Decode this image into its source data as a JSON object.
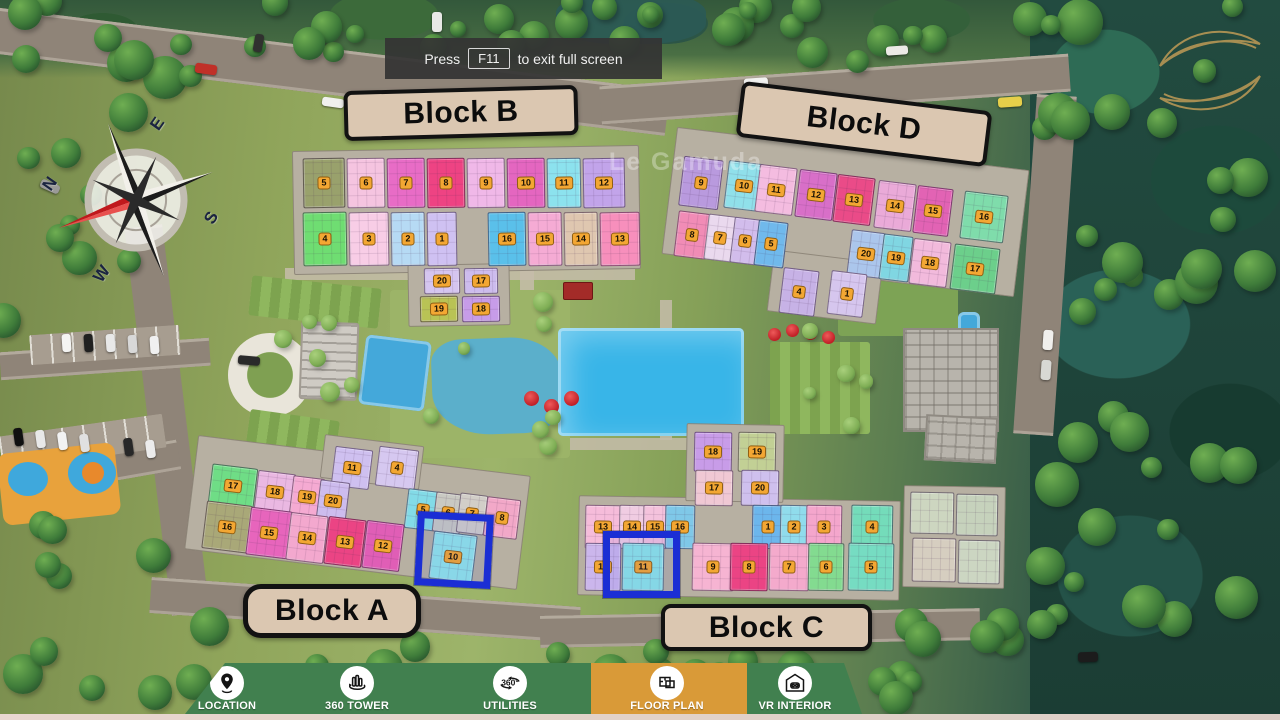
{
  "toast": {
    "prefix": "Press",
    "key": "F11",
    "suffix": "to exit full screen"
  },
  "watermark": "Le Gamuda",
  "compass": {
    "n": "N",
    "e": "E",
    "s": "S",
    "w": "W"
  },
  "block_labels": [
    {
      "text": "Block B"
    },
    {
      "text": "Block D"
    },
    {
      "text": "Block A"
    },
    {
      "text": "Block C"
    }
  ],
  "highlighted_units": [
    {
      "block": "Block A",
      "unit": "10"
    },
    {
      "block": "Block C",
      "unit": "11"
    }
  ],
  "nav": {
    "background": "#41804f",
    "active_background": "#d99a38",
    "items": [
      {
        "label": "LOCATION",
        "icon": "location-pin-icon",
        "active": false
      },
      {
        "label": "360 TOWER",
        "icon": "tower-360-icon",
        "active": false
      },
      {
        "label": "UTILITIES",
        "icon": "utilities-360-icon",
        "active": false
      },
      {
        "label": "FLOOR PLAN",
        "icon": "floor-plan-icon",
        "active": true
      },
      {
        "label": "VR INTERIOR",
        "icon": "vr-interior-icon",
        "active": false
      }
    ]
  },
  "map": {
    "highlights": [
      {
        "x": 416,
        "y": 513,
        "w": 76,
        "h": 74,
        "rot": 3
      },
      {
        "x": 603,
        "y": 531,
        "w": 77,
        "h": 67,
        "rot": 0
      }
    ],
    "blocks": [
      {
        "name": "Block B",
        "rot": -1,
        "slabs": [
          {
            "x": 293,
            "y": 148,
            "w": 347,
            "h": 124
          },
          {
            "x": 408,
            "y": 264,
            "w": 102,
            "h": 62
          }
        ],
        "units": [
          {
            "n": "5",
            "x": 303,
            "y": 158,
            "w": 42,
            "h": 50,
            "c": "#99a16c"
          },
          {
            "n": "6",
            "x": 347,
            "y": 158,
            "w": 38,
            "h": 50,
            "c": "#f5c4e0"
          },
          {
            "n": "7",
            "x": 387,
            "y": 158,
            "w": 38,
            "h": 50,
            "c": "#e86cc6"
          },
          {
            "n": "8",
            "x": 427,
            "y": 158,
            "w": 38,
            "h": 50,
            "c": "#ee4383"
          },
          {
            "n": "9",
            "x": 467,
            "y": 158,
            "w": 38,
            "h": 50,
            "c": "#f0b8e8"
          },
          {
            "n": "10",
            "x": 507,
            "y": 158,
            "w": 38,
            "h": 50,
            "c": "#e466c0"
          },
          {
            "n": "11",
            "x": 547,
            "y": 158,
            "w": 34,
            "h": 50,
            "c": "#8ce2ee"
          },
          {
            "n": "12",
            "x": 583,
            "y": 158,
            "w": 42,
            "h": 50,
            "c": "#c2a4ea"
          },
          {
            "n": "4",
            "x": 303,
            "y": 212,
            "w": 44,
            "h": 54,
            "c": "#6fdd72"
          },
          {
            "n": "3",
            "x": 349,
            "y": 212,
            "w": 40,
            "h": 54,
            "c": "#f8cde6"
          },
          {
            "n": "2",
            "x": 391,
            "y": 212,
            "w": 34,
            "h": 54,
            "c": "#b6daf4"
          },
          {
            "n": "1",
            "x": 427,
            "y": 212,
            "w": 30,
            "h": 54,
            "c": "#cfc1f2"
          },
          {
            "n": "16",
            "x": 488,
            "y": 212,
            "w": 38,
            "h": 54,
            "c": "#5ac0ea"
          },
          {
            "n": "15",
            "x": 528,
            "y": 212,
            "w": 34,
            "h": 54,
            "c": "#f5abd4"
          },
          {
            "n": "14",
            "x": 564,
            "y": 212,
            "w": 34,
            "h": 54,
            "c": "#dfc7b0"
          },
          {
            "n": "13",
            "x": 600,
            "y": 212,
            "w": 40,
            "h": 54,
            "c": "#f78fbc"
          },
          {
            "n": "20",
            "x": 424,
            "y": 268,
            "w": 36,
            "h": 26,
            "c": "#d5c5f0"
          },
          {
            "n": "17",
            "x": 464,
            "y": 268,
            "w": 34,
            "h": 26,
            "c": "#cdbcee"
          },
          {
            "n": "19",
            "x": 420,
            "y": 296,
            "w": 38,
            "h": 26,
            "c": "#b9c355"
          },
          {
            "n": "18",
            "x": 462,
            "y": 296,
            "w": 38,
            "h": 26,
            "c": "#c79ce8"
          }
        ]
      },
      {
        "name": "Block D",
        "rot": 7,
        "slabs": [
          {
            "x": 668,
            "y": 148,
            "w": 355,
            "h": 128
          },
          {
            "x": 770,
            "y": 256,
            "w": 110,
            "h": 62
          }
        ],
        "units": [
          {
            "n": "9",
            "x": 681,
            "y": 158,
            "w": 40,
            "h": 50,
            "c": "#b99ade"
          },
          {
            "n": "10",
            "x": 726,
            "y": 162,
            "w": 36,
            "h": 48,
            "c": "#90e0ea"
          },
          {
            "n": "11",
            "x": 757,
            "y": 166,
            "w": 38,
            "h": 48,
            "c": "#f4bce0"
          },
          {
            "n": "12",
            "x": 797,
            "y": 171,
            "w": 38,
            "h": 48,
            "c": "#d86fc8"
          },
          {
            "n": "13",
            "x": 835,
            "y": 176,
            "w": 38,
            "h": 48,
            "c": "#ea4b88"
          },
          {
            "n": "14",
            "x": 876,
            "y": 182,
            "w": 38,
            "h": 48,
            "c": "#eaaad8"
          },
          {
            "n": "15",
            "x": 915,
            "y": 187,
            "w": 36,
            "h": 48,
            "c": "#e263b4"
          },
          {
            "n": "16",
            "x": 962,
            "y": 193,
            "w": 44,
            "h": 48,
            "c": "#7fdcab"
          },
          {
            "n": "8",
            "x": 676,
            "y": 212,
            "w": 32,
            "h": 46,
            "c": "#f18cb6"
          },
          {
            "n": "7",
            "x": 706,
            "y": 215,
            "w": 28,
            "h": 46,
            "c": "#ead9ee"
          },
          {
            "n": "6",
            "x": 732,
            "y": 218,
            "w": 26,
            "h": 46,
            "c": "#d2bdec"
          },
          {
            "n": "5",
            "x": 756,
            "y": 221,
            "w": 30,
            "h": 46,
            "c": "#70b9ec"
          },
          {
            "n": "20",
            "x": 849,
            "y": 231,
            "w": 34,
            "h": 46,
            "c": "#abc6ec"
          },
          {
            "n": "19",
            "x": 881,
            "y": 235,
            "w": 30,
            "h": 46,
            "c": "#80d6e2"
          },
          {
            "n": "18",
            "x": 911,
            "y": 240,
            "w": 38,
            "h": 46,
            "c": "#f2badc"
          },
          {
            "n": "17",
            "x": 952,
            "y": 246,
            "w": 46,
            "h": 46,
            "c": "#6ccf8b"
          },
          {
            "n": "4",
            "x": 781,
            "y": 269,
            "w": 36,
            "h": 46,
            "c": "#c7b2e6"
          },
          {
            "n": "1",
            "x": 829,
            "y": 272,
            "w": 36,
            "h": 44,
            "c": "#d6c6ee"
          }
        ]
      },
      {
        "name": "Block A",
        "rot": 7,
        "slabs": [
          {
            "x": 190,
            "y": 455,
            "w": 335,
            "h": 115
          },
          {
            "x": 322,
            "y": 440,
            "w": 100,
            "h": 44
          }
        ],
        "units": [
          {
            "n": "11",
            "x": 333,
            "y": 448,
            "w": 38,
            "h": 40,
            "c": "#cfc0f0"
          },
          {
            "n": "4",
            "x": 377,
            "y": 448,
            "w": 40,
            "h": 40,
            "c": "#d6c8f0"
          },
          {
            "n": "17",
            "x": 210,
            "y": 466,
            "w": 46,
            "h": 40,
            "c": "#6fdd86"
          },
          {
            "n": "18",
            "x": 256,
            "y": 472,
            "w": 38,
            "h": 40,
            "c": "#eab8e2"
          },
          {
            "n": "19",
            "x": 291,
            "y": 477,
            "w": 32,
            "h": 40,
            "c": "#f5aad2"
          },
          {
            "n": "20",
            "x": 318,
            "y": 481,
            "w": 30,
            "h": 40,
            "c": "#cdbcee"
          },
          {
            "n": "5",
            "x": 406,
            "y": 490,
            "w": 34,
            "h": 40,
            "c": "#83dbe7"
          },
          {
            "n": "6",
            "x": 434,
            "y": 493,
            "w": 28,
            "h": 40,
            "c": "#c9c9c2"
          },
          {
            "n": "7",
            "x": 458,
            "y": 494,
            "w": 28,
            "h": 40,
            "c": "#d2cec8"
          },
          {
            "n": "8",
            "x": 485,
            "y": 498,
            "w": 34,
            "h": 40,
            "c": "#f2a8c8"
          },
          {
            "n": "16",
            "x": 204,
            "y": 503,
            "w": 46,
            "h": 48,
            "c": "#a9a878"
          },
          {
            "n": "15",
            "x": 248,
            "y": 509,
            "w": 42,
            "h": 48,
            "c": "#e765bc"
          },
          {
            "n": "14",
            "x": 288,
            "y": 514,
            "w": 38,
            "h": 48,
            "c": "#f3a8ce"
          },
          {
            "n": "13",
            "x": 326,
            "y": 518,
            "w": 38,
            "h": 48,
            "c": "#eb4484"
          },
          {
            "n": "12",
            "x": 364,
            "y": 522,
            "w": 38,
            "h": 48,
            "c": "#e05eb6"
          },
          {
            "n": "10",
            "x": 431,
            "y": 533,
            "w": 44,
            "h": 48,
            "c": "#92e4e9"
          }
        ]
      },
      {
        "name": "Block C",
        "rot": 1,
        "slabs": [
          {
            "x": 578,
            "y": 498,
            "w": 322,
            "h": 100
          },
          {
            "x": 686,
            "y": 424,
            "w": 98,
            "h": 78
          },
          {
            "x": 903,
            "y": 486,
            "w": 102,
            "h": 102
          }
        ],
        "units": [
          {
            "n": "18",
            "x": 694,
            "y": 432,
            "w": 38,
            "h": 40,
            "c": "#c89ce8"
          },
          {
            "n": "19",
            "x": 738,
            "y": 432,
            "w": 38,
            "h": 40,
            "c": "#c2d095"
          },
          {
            "n": "17",
            "x": 695,
            "y": 470,
            "w": 38,
            "h": 36,
            "c": "#f0c8d4"
          },
          {
            "n": "20",
            "x": 741,
            "y": 470,
            "w": 38,
            "h": 36,
            "c": "#cfc0ee"
          },
          {
            "n": "13",
            "x": 585,
            "y": 505,
            "w": 36,
            "h": 44,
            "c": "#f6bcda"
          },
          {
            "n": "14",
            "x": 619,
            "y": 505,
            "w": 26,
            "h": 44,
            "c": "#f0cce2"
          },
          {
            "n": "15",
            "x": 643,
            "y": 505,
            "w": 24,
            "h": 44,
            "c": "#f4c2dc"
          },
          {
            "n": "16",
            "x": 665,
            "y": 505,
            "w": 30,
            "h": 44,
            "c": "#7fc8e8"
          },
          {
            "n": "1",
            "x": 752,
            "y": 505,
            "w": 32,
            "h": 44,
            "c": "#6cb6ec"
          },
          {
            "n": "2",
            "x": 780,
            "y": 505,
            "w": 28,
            "h": 44,
            "c": "#90dcec"
          },
          {
            "n": "3",
            "x": 806,
            "y": 505,
            "w": 36,
            "h": 44,
            "c": "#f4a6cc"
          },
          {
            "n": "4",
            "x": 851,
            "y": 505,
            "w": 42,
            "h": 44,
            "c": "#74dcba"
          },
          {
            "n": "12",
            "x": 585,
            "y": 543,
            "w": 36,
            "h": 48,
            "c": "#cbb6ec"
          },
          {
            "n": "11",
            "x": 622,
            "y": 543,
            "w": 42,
            "h": 48,
            "c": "#8ee4e6"
          },
          {
            "n": "9",
            "x": 692,
            "y": 543,
            "w": 42,
            "h": 48,
            "c": "#f6b4d2"
          },
          {
            "n": "8",
            "x": 730,
            "y": 543,
            "w": 38,
            "h": 48,
            "c": "#eb4484"
          },
          {
            "n": "7",
            "x": 769,
            "y": 543,
            "w": 40,
            "h": 48,
            "c": "#f4aacc"
          },
          {
            "n": "6",
            "x": 808,
            "y": 543,
            "w": 36,
            "h": 48,
            "c": "#83db90"
          },
          {
            "n": "5",
            "x": 848,
            "y": 543,
            "w": 46,
            "h": 48,
            "c": "#76dcc2"
          },
          {
            "n": "",
            "x": 910,
            "y": 492,
            "w": 44,
            "h": 42,
            "c": "#cdd6c0"
          },
          {
            "n": "",
            "x": 956,
            "y": 494,
            "w": 42,
            "h": 42,
            "c": "#c6d2bc"
          },
          {
            "n": "",
            "x": 912,
            "y": 538,
            "w": 44,
            "h": 44,
            "c": "#d6cec0"
          },
          {
            "n": "",
            "x": 958,
            "y": 540,
            "w": 42,
            "h": 44,
            "c": "#ccd6c2"
          }
        ]
      }
    ]
  }
}
